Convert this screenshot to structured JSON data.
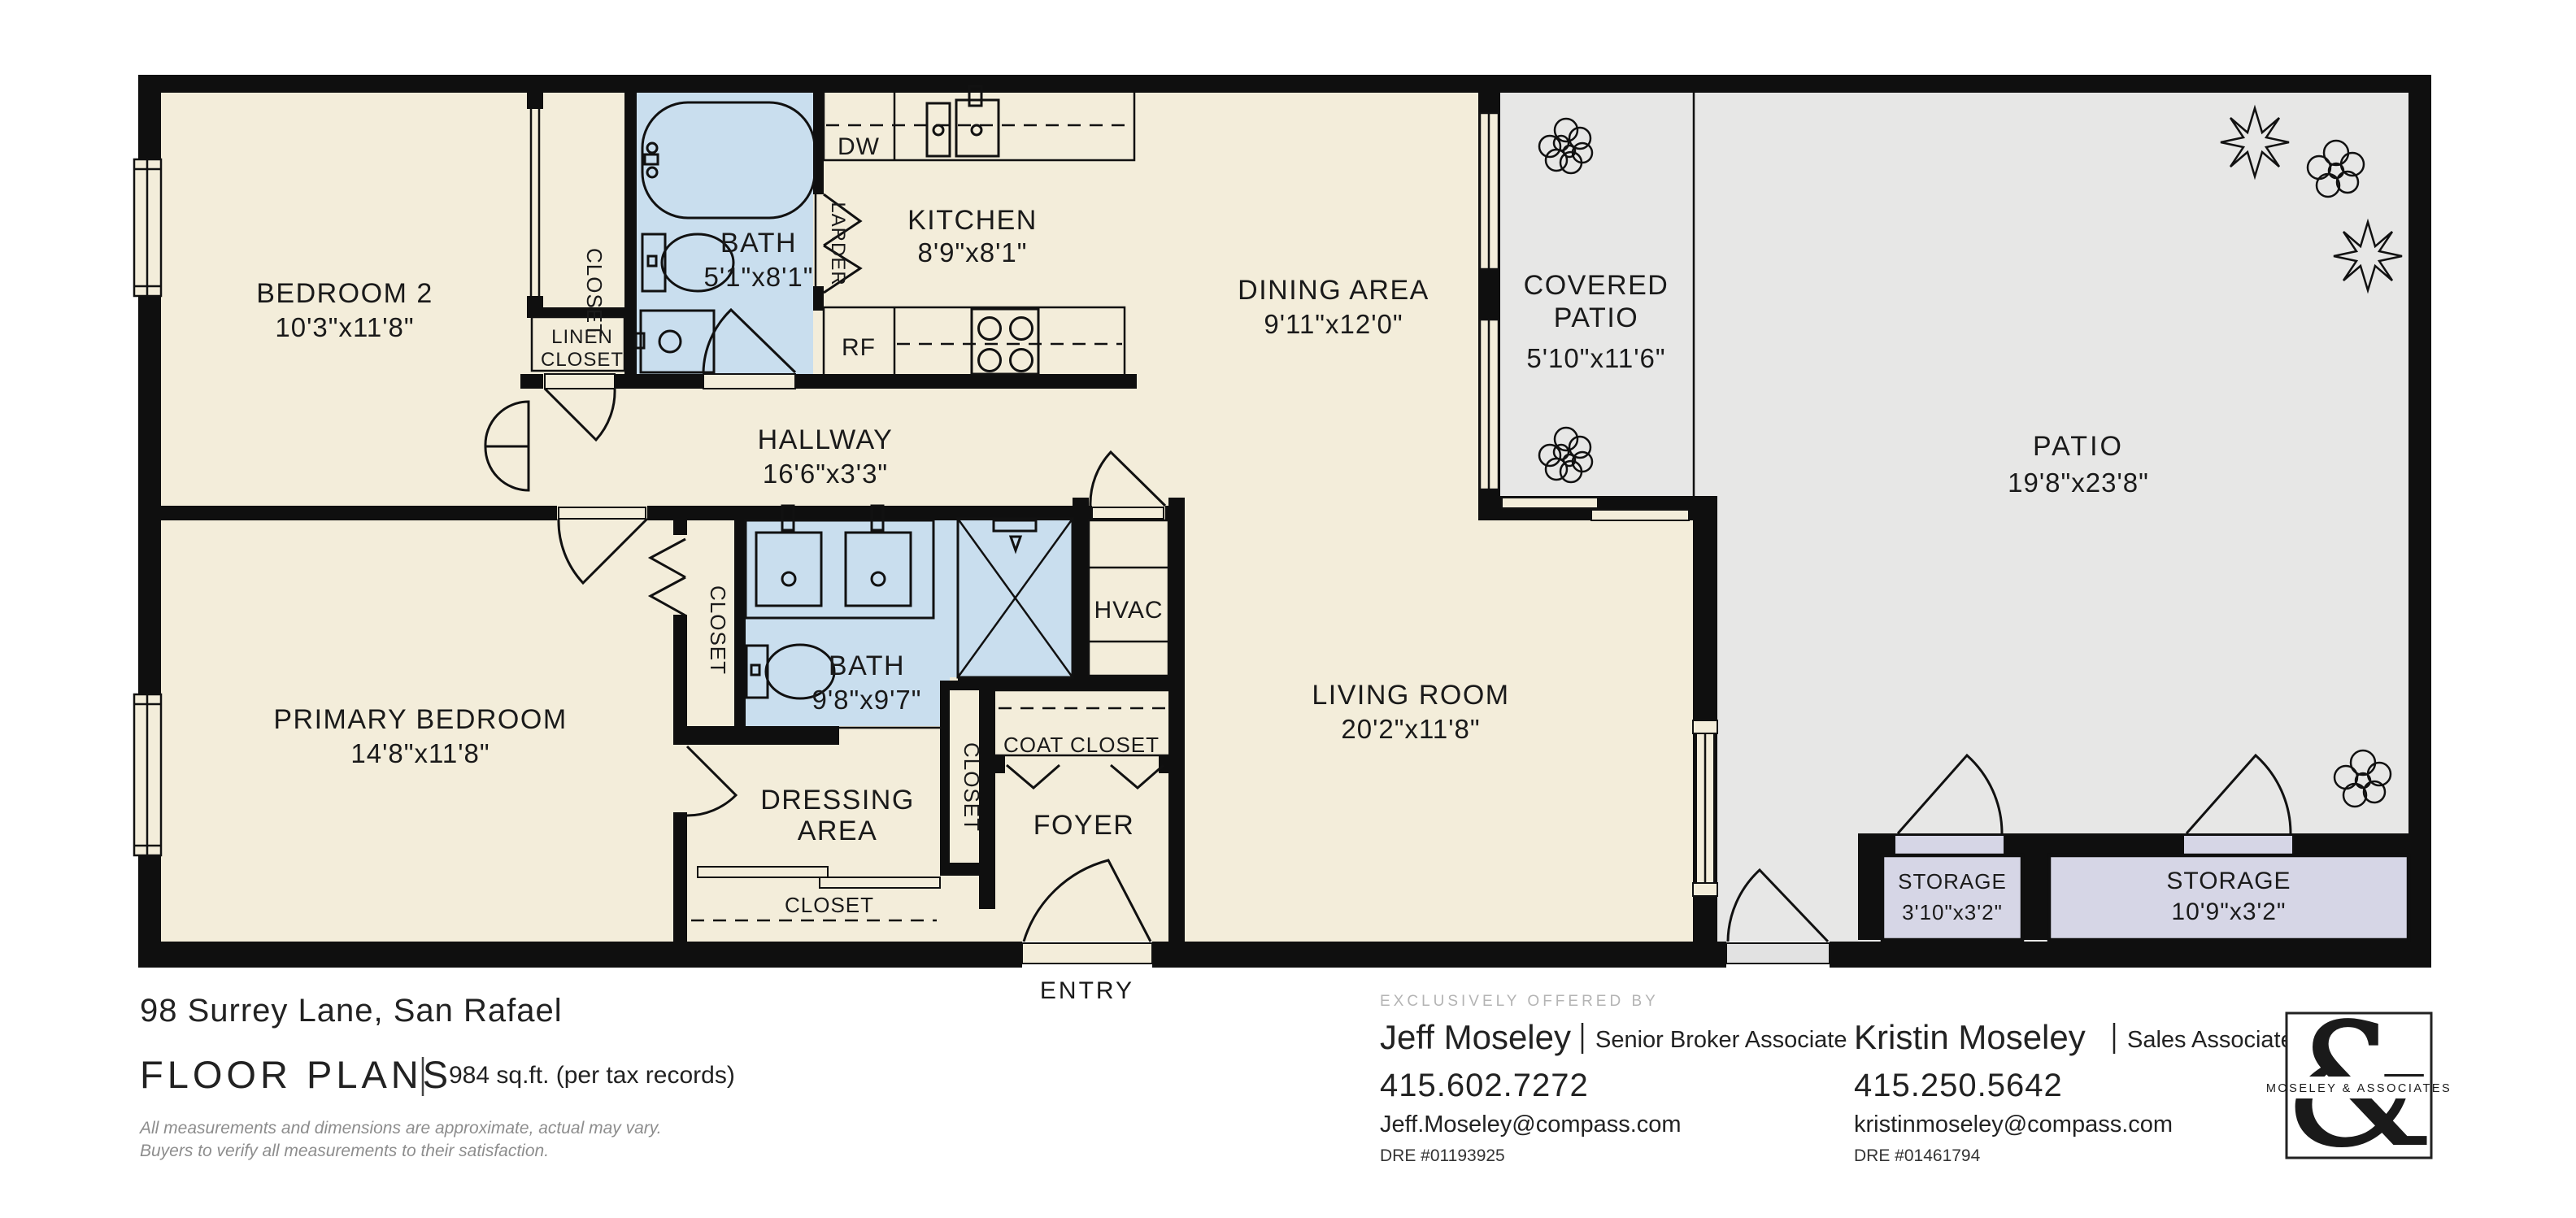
{
  "rooms": {
    "bedroom2": {
      "name": "BEDROOM 2",
      "dims": "10'3\"x11'8\""
    },
    "bath_upper": {
      "name": "BATH",
      "dims": "5'1\"x8'1\""
    },
    "kitchen": {
      "name": "KITCHEN",
      "dims": "8'9\"x8'1\""
    },
    "hallway": {
      "name": "HALLWAY",
      "dims": "16'6\"x3'3\""
    },
    "dining_area": {
      "name": "DINING AREA",
      "dims": "9'11\"x12'0\""
    },
    "covered_patio": {
      "line1": "COVERED",
      "line2": "PATIO",
      "dims": "5'10\"x11'6\""
    },
    "patio": {
      "name": "PATIO",
      "dims": "19'8\"x23'8\""
    },
    "living_room": {
      "name": "LIVING ROOM",
      "dims": "20'2\"x11'8\""
    },
    "primary_bedroom": {
      "name": "PRIMARY BEDROOM",
      "dims": "14'8\"x11'8\""
    },
    "bath_lower": {
      "name": "BATH",
      "dims": "9'8\"x9'7\""
    },
    "dressing_area": {
      "line1": "DRESSING",
      "line2": "AREA"
    },
    "foyer": {
      "name": "FOYER"
    },
    "entry": {
      "name": "ENTRY"
    },
    "hvac": {
      "name": "HVAC"
    },
    "storage_small": {
      "name": "STORAGE",
      "dims": "3'10\"x3'2\""
    },
    "storage_large": {
      "name": "STORAGE",
      "dims": "10'9\"x3'2\""
    }
  },
  "labels": {
    "closet": "CLOSET",
    "linen_line1": "LINEN",
    "linen_line2": "CLOSET",
    "coat_closet": "COAT CLOSET",
    "larder": "LARDER",
    "dishwasher": "DW",
    "refrigerator": "RF"
  },
  "footer": {
    "address": "98 Surrey Lane, San Rafael",
    "plans_title": "FLOOR PLANS",
    "area_note": "984 sq.ft. (per tax records)",
    "disclaimer_line1": "All measurements and dimensions are approximate, actual may vary.",
    "disclaimer_line2": "Buyers to verify all measurements to their satisfaction.",
    "offered_by": "EXCLUSIVELY OFFERED BY",
    "agents": [
      {
        "name": "Jeff Moseley",
        "role": "Senior Broker Associate",
        "phone": "415.602.7272",
        "email": "Jeff.Moseley@compass.com",
        "dre": "DRE #01193925"
      },
      {
        "name": "Kristin Moseley",
        "role": "Sales Associate",
        "phone": "415.250.5642",
        "email": "kristinmoseley@compass.com",
        "dre": "DRE #01461794"
      }
    ],
    "logo": {
      "ampersand": "&",
      "name": "MOSELEY & ASSOCIATES"
    }
  },
  "colors": {
    "floor": "#f3edda",
    "patio": "#e7e7e6",
    "bath": "#c9deee",
    "storage": "#d6d6e6",
    "wall": "#0f0f0f"
  }
}
